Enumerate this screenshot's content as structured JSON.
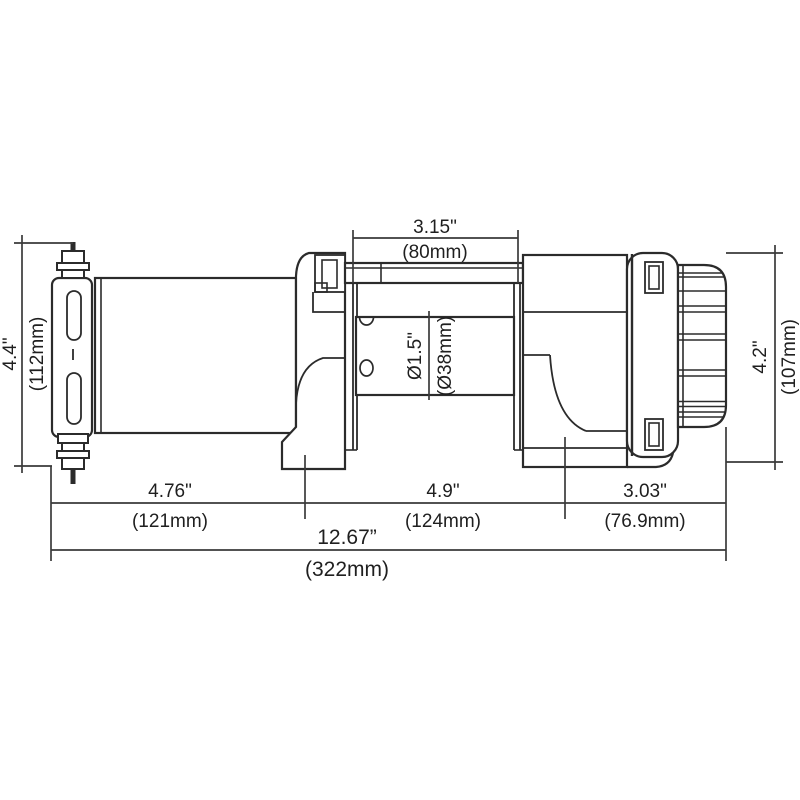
{
  "diagram": {
    "type": "technical-dimension-drawing",
    "subject": "electric winch side view",
    "line_color": "#2b2b2b",
    "dimension_color": "#3a3a3a",
    "dimensions": {
      "top_width": {
        "inches": "3.15\"",
        "mm": "(80mm)"
      },
      "left_height": {
        "inches": "4.4\"",
        "mm": "(112mm)"
      },
      "right_height": {
        "inches": "4.2\"",
        "mm": "(107mm)"
      },
      "drum_diameter": {
        "inches": "Ø1.5\"",
        "mm": "(Ø38mm)"
      },
      "bottom_left": {
        "inches": "4.76\"",
        "mm": "(121mm)"
      },
      "bottom_middle": {
        "inches": "4.9\"",
        "mm": "(124mm)"
      },
      "bottom_right": {
        "inches": "3.03\"",
        "mm": "(76.9mm)"
      },
      "overall_width": {
        "inches": "12.67”",
        "mm": "(322mm)"
      }
    }
  }
}
